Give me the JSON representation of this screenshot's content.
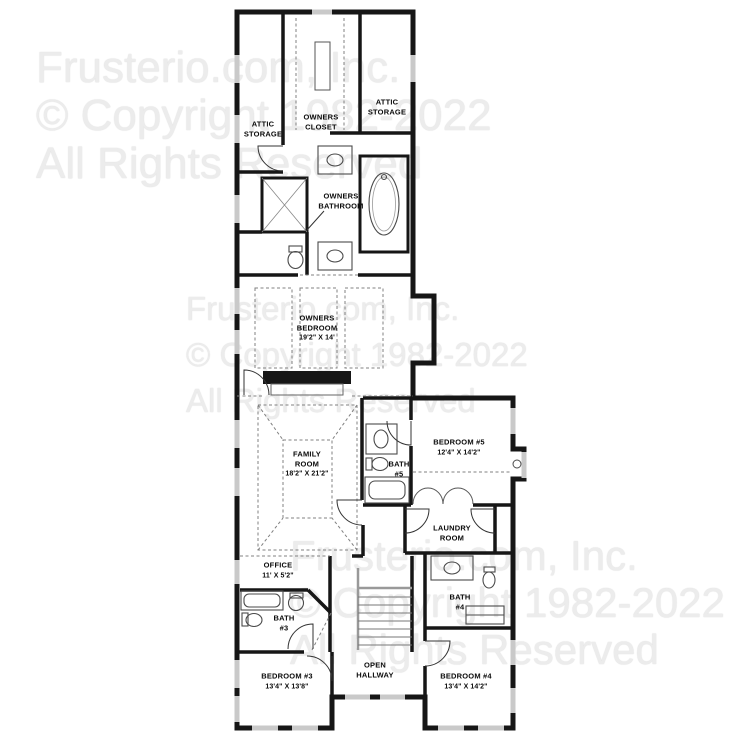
{
  "watermark": {
    "lines": [
      "Frusterio.com, Inc.",
      "© Copyright 1982-2022",
      "All Rights Reserved"
    ],
    "color": "#ececec"
  },
  "colors": {
    "wall": "#161616",
    "fixture": "#4a4a4a",
    "dashed_line": "#808080",
    "window_sill": "#c9c9c9",
    "label_text": "#0a0a0a"
  },
  "rooms": [
    {
      "id": "attic-storage-left",
      "name": "ATTIC\nSTORAGE",
      "dims": ""
    },
    {
      "id": "owners-closet",
      "name": "OWNERS\nCLOSET",
      "dims": ""
    },
    {
      "id": "attic-storage-right",
      "name": "ATTIC\nSTORAGE",
      "dims": ""
    },
    {
      "id": "owners-bathroom",
      "name": "OWNERS\nBATHROOM",
      "dims": ""
    },
    {
      "id": "owners-bedroom",
      "name": "OWNERS\nBEDROOM",
      "dims": "19'2\" X 14'"
    },
    {
      "id": "family-room",
      "name": "FAMILY\nROOM",
      "dims": "18'2\" X 21'2\""
    },
    {
      "id": "bath-5",
      "name": "BATH\n#5",
      "dims": ""
    },
    {
      "id": "bedroom-5",
      "name": "BEDROOM #5",
      "dims": "12'4\" X 14'2\""
    },
    {
      "id": "laundry-room",
      "name": "LAUNDRY\nROOM",
      "dims": ""
    },
    {
      "id": "office",
      "name": "OFFICE",
      "dims": "11' X 5'2\""
    },
    {
      "id": "bath-3",
      "name": "BATH\n#3",
      "dims": ""
    },
    {
      "id": "bath-4",
      "name": "BATH\n#4",
      "dims": ""
    },
    {
      "id": "bedroom-3",
      "name": "BEDROOM #3",
      "dims": "13'4\" X 13'8\""
    },
    {
      "id": "open-hallway",
      "name": "OPEN\nHALLWAY",
      "dims": ""
    },
    {
      "id": "bedroom-4",
      "name": "BEDROOM #4",
      "dims": "13'4\" X 14'2\""
    }
  ]
}
